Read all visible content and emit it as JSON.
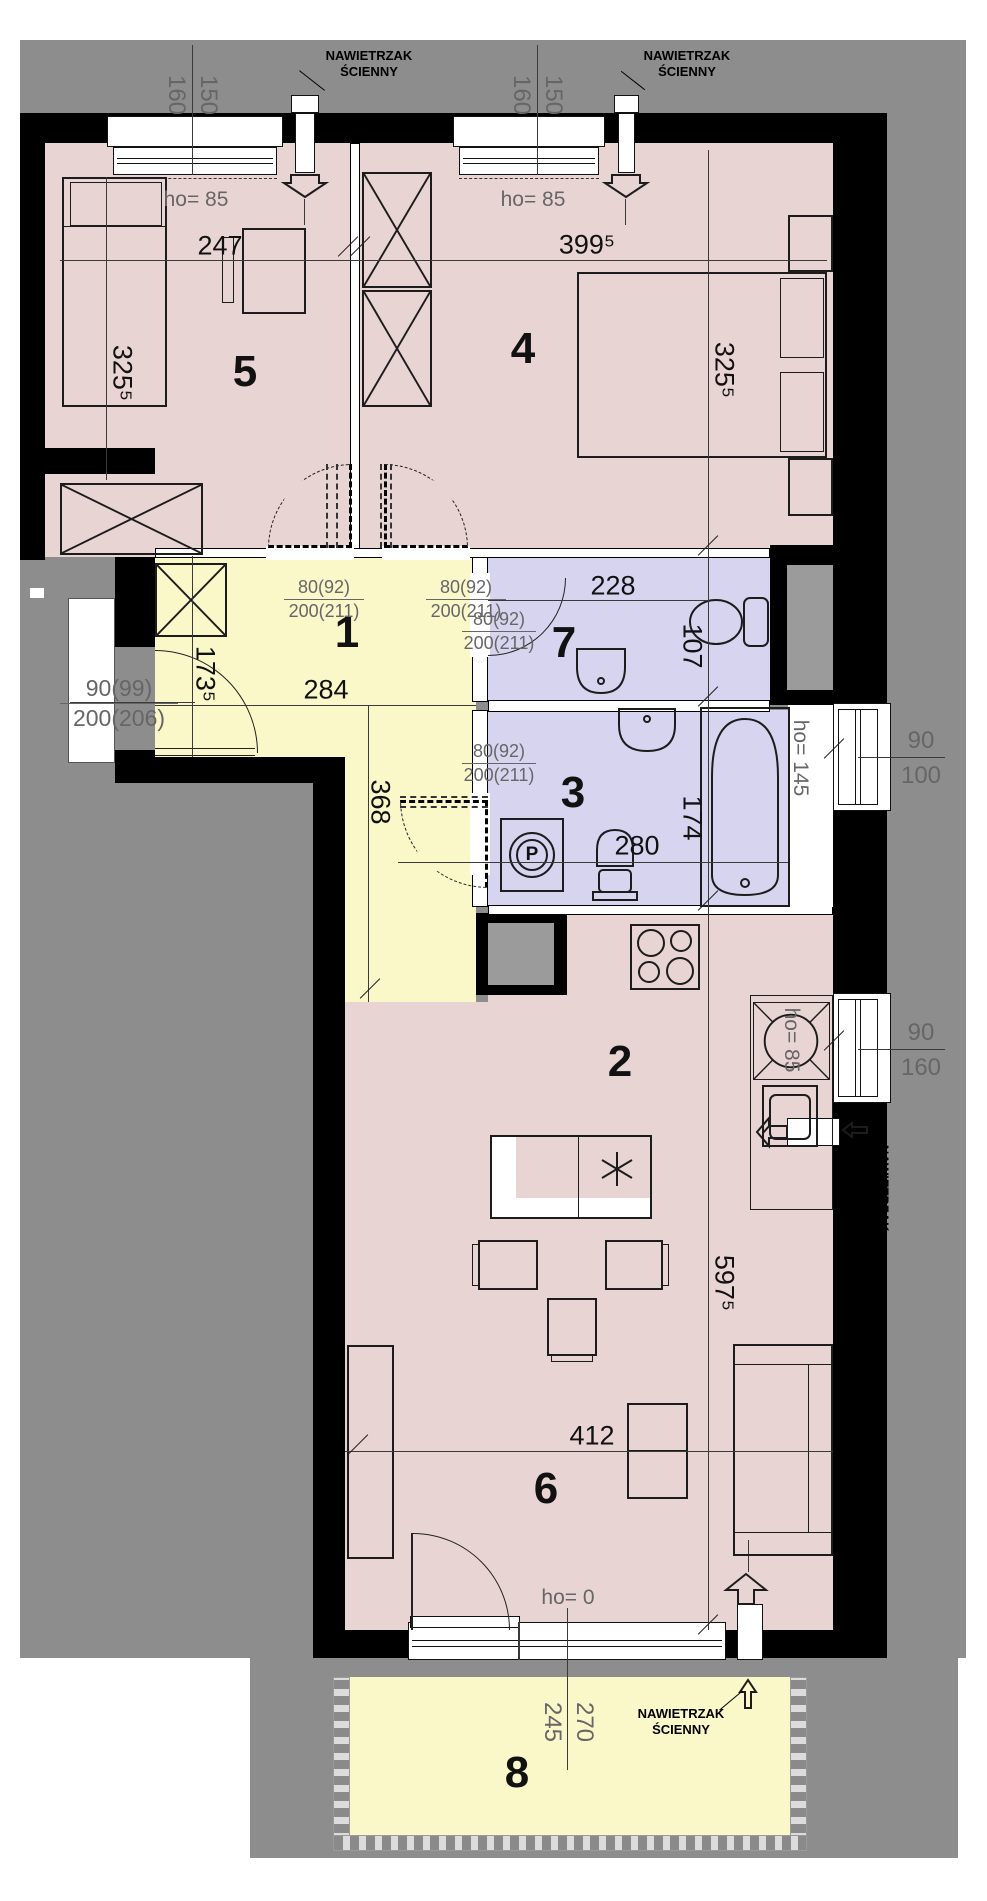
{
  "floorplan": {
    "vent_label": "NAWIETRZAK ŚCIENNY",
    "room_numbers": {
      "hall": "1",
      "kitchen_dining": "2",
      "bathroom": "3",
      "bedroom_right": "4",
      "bedroom_left": "5",
      "living": "6",
      "wc": "7",
      "balcony": "8"
    },
    "dims": {
      "bedroom_left_width": "247",
      "bedroom_right_width": "399⁵",
      "bedroom_depth": "325⁵",
      "hall_width": "284",
      "hall_depth": "173⁵",
      "corridor_length": "368",
      "wc_width": "228",
      "wc_depth": "107",
      "bath_width": "280",
      "bath_depth": "174",
      "living_width": "412",
      "living_depth": "597⁵",
      "balcony_depth_a": "245",
      "balcony_depth_b": "270"
    },
    "windows": {
      "top_h": "160",
      "top_w": "150",
      "bath_h": "90",
      "bath_w": "100",
      "kitchen_h": "90",
      "kitchen_w": "160"
    },
    "sill_heights": {
      "standard": "ho= 85",
      "bathtub": "ho= 145",
      "balcony_door": "ho= 0"
    },
    "doors": {
      "interior_width": "80(92)",
      "interior_height": "200(211)",
      "entry_width": "90(99)",
      "entry_height": "200(206)"
    },
    "washer_symbol": "P",
    "colors": {
      "room_pink": "#e9d4d4",
      "room_yellow": "#faf7c9",
      "room_lavender": "#d7d4f0",
      "wall_black": "#000000",
      "outside_gray": "#8d8d8d"
    }
  }
}
